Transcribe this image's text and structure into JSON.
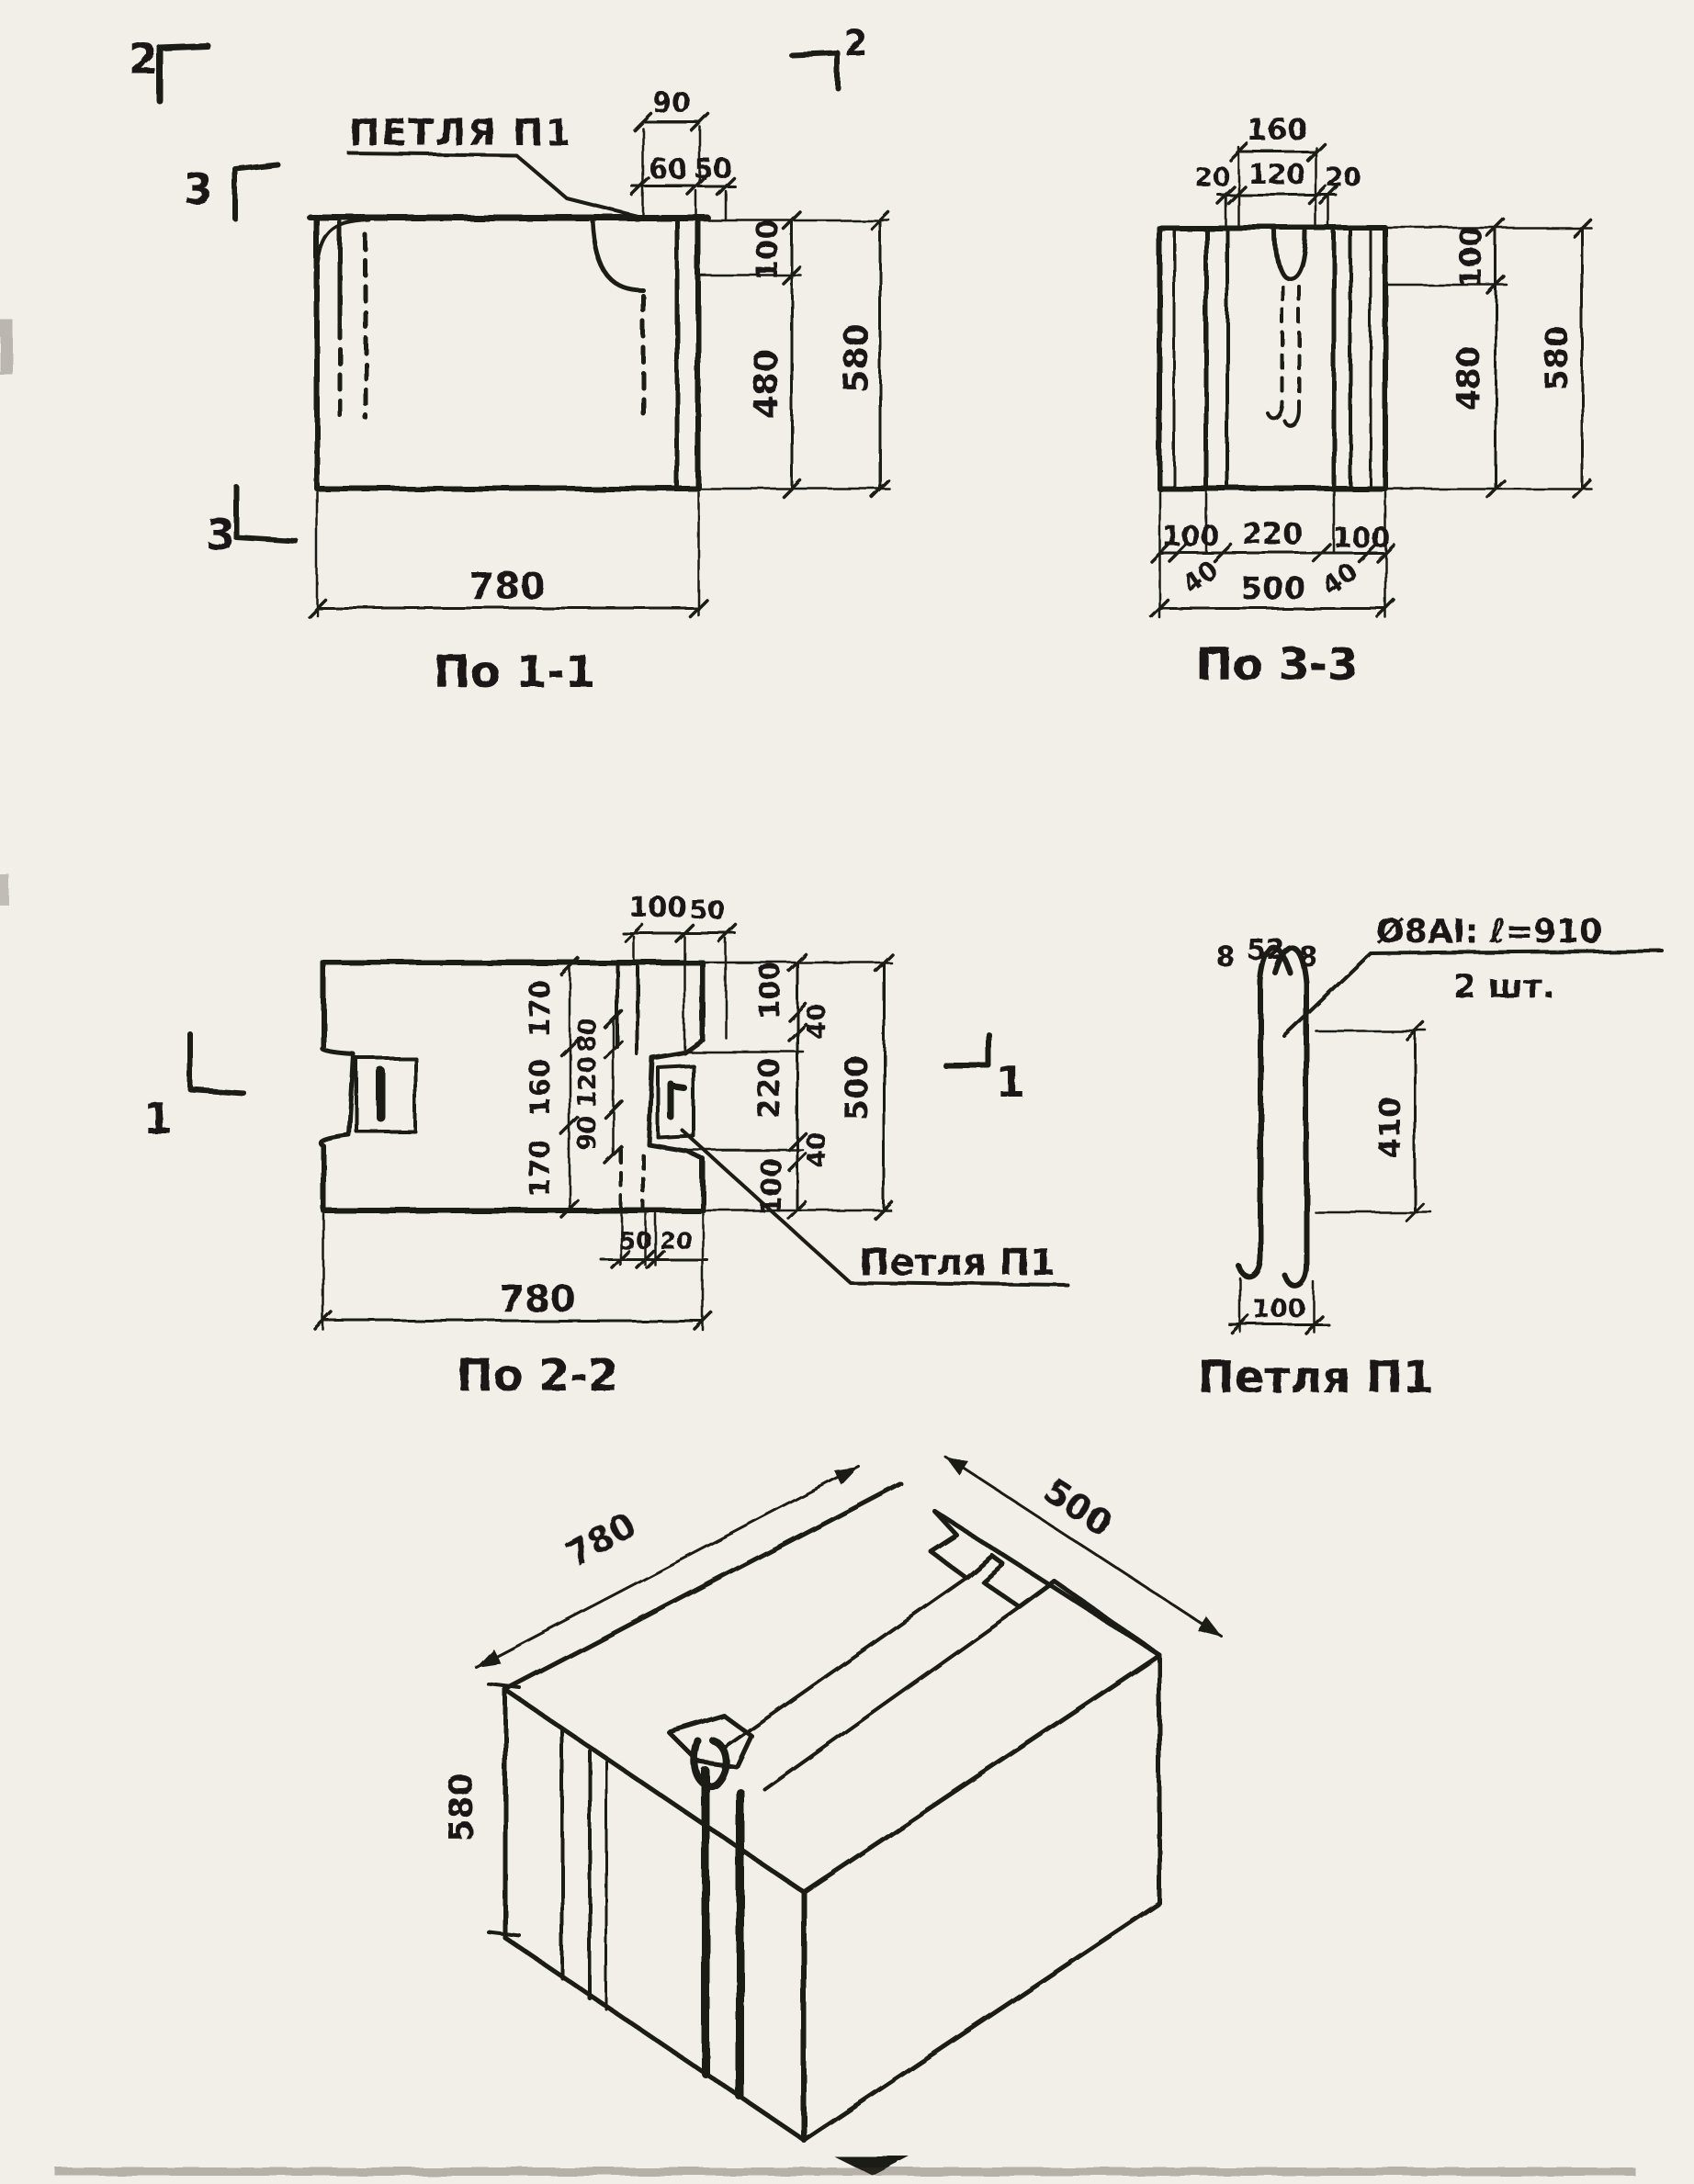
{
  "markers": {
    "sec2_left": "2",
    "sec2_right": "2",
    "sec3_top": "3",
    "sec3_bottom": "3",
    "sec1_left": "1",
    "sec1_right": "1"
  },
  "callout_top": {
    "text": "ПЕТЛЯ П1"
  },
  "view_1_1": {
    "title": "По 1-1",
    "dims": {
      "w90": "90",
      "w60": "60",
      "w50": "50",
      "h100": "100",
      "h480": "480",
      "h580": "580",
      "w780": "780"
    }
  },
  "view_3_3": {
    "title": "По 3-3",
    "dims": {
      "t160": "160",
      "t20l": "20",
      "t120": "120",
      "t20r": "20",
      "r100": "100",
      "r480": "480",
      "r580": "580",
      "b100l": "100",
      "b220": "220",
      "b100r": "100",
      "b40l": "40",
      "b500": "500",
      "b40r": "40"
    }
  },
  "view_2_2": {
    "title": "По 2-2",
    "callout": "Петля П1",
    "dims": {
      "t100": "100",
      "t50": "50",
      "l170a": "170",
      "l160": "160",
      "l170b": "170",
      "i80": "80",
      "i120": "120",
      "i90": "90",
      "r100a": "100",
      "r40a": "40",
      "r220": "220",
      "r40b": "40",
      "r100b": "100",
      "r500": "500",
      "b50": "50",
      "b20": "20",
      "b780": "780"
    }
  },
  "loop_detail": {
    "title": "Петля П1",
    "note1": "Ø8АI: ℓ=910",
    "note2": "2 шт.",
    "dims": {
      "t8l": "8",
      "t52": "52",
      "t8r": "8",
      "h410": "410",
      "b100": "100"
    }
  },
  "isometric": {
    "dims": {
      "d780": "780",
      "d500": "500",
      "d580": "580"
    }
  }
}
